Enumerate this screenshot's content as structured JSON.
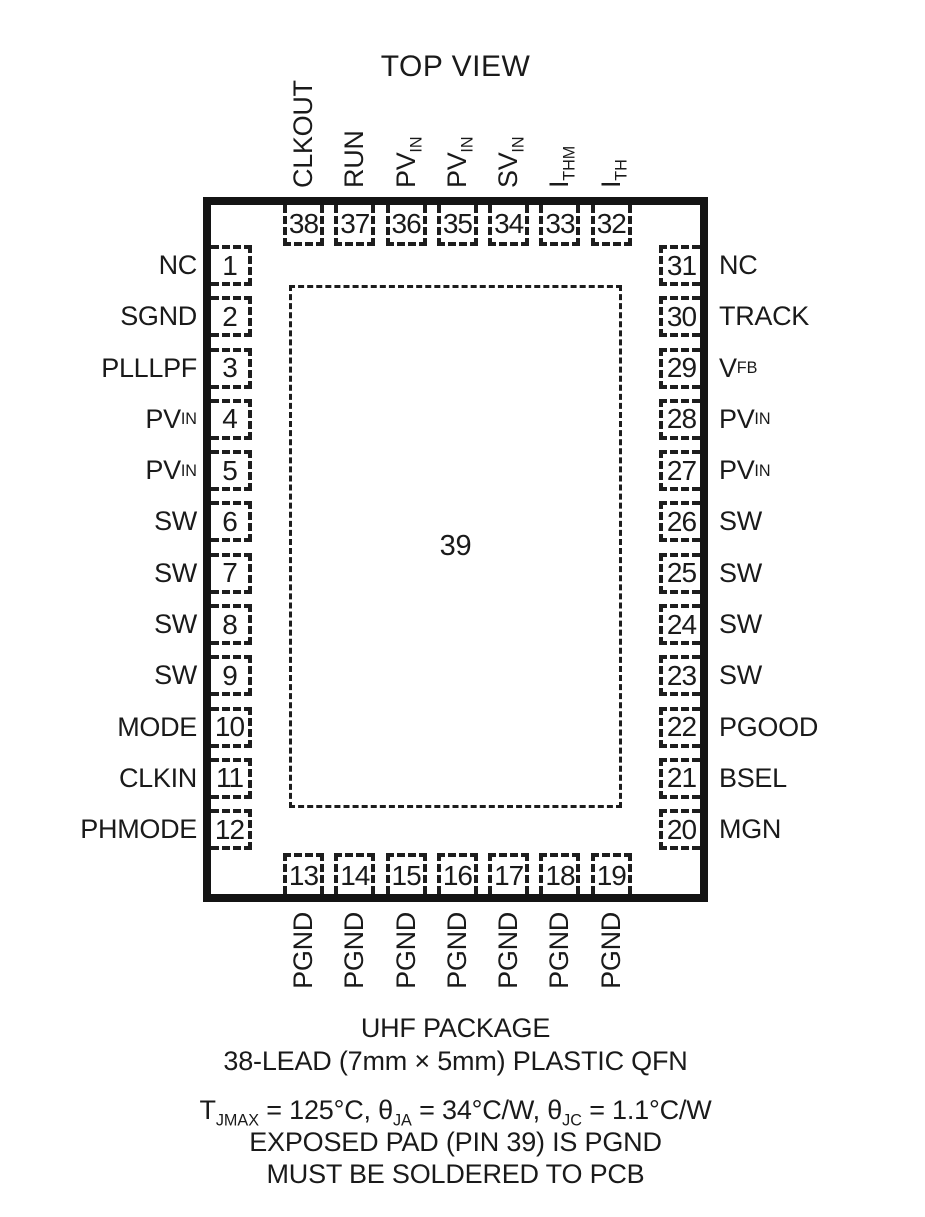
{
  "title": "TOP VIEW",
  "colors": {
    "ink": "#1a1a1a",
    "background": "#ffffff"
  },
  "exposed_pad": {
    "num": "39"
  },
  "pins": {
    "top": [
      {
        "num": "38",
        "main": "CLKOUT",
        "sub": ""
      },
      {
        "num": "37",
        "main": "RUN",
        "sub": ""
      },
      {
        "num": "36",
        "main": "PV",
        "sub": "IN"
      },
      {
        "num": "35",
        "main": "PV",
        "sub": "IN"
      },
      {
        "num": "34",
        "main": "SV",
        "sub": "IN"
      },
      {
        "num": "33",
        "main": "I",
        "sub": "THM"
      },
      {
        "num": "32",
        "main": "I",
        "sub": "TH"
      }
    ],
    "left": [
      {
        "num": "1",
        "main": "NC",
        "sub": ""
      },
      {
        "num": "2",
        "main": "SGND",
        "sub": ""
      },
      {
        "num": "3",
        "main": "PLLLPF",
        "sub": ""
      },
      {
        "num": "4",
        "main": "PV",
        "sub": "IN"
      },
      {
        "num": "5",
        "main": "PV",
        "sub": "IN"
      },
      {
        "num": "6",
        "main": "SW",
        "sub": ""
      },
      {
        "num": "7",
        "main": "SW",
        "sub": ""
      },
      {
        "num": "8",
        "main": "SW",
        "sub": ""
      },
      {
        "num": "9",
        "main": "SW",
        "sub": ""
      },
      {
        "num": "10",
        "main": "MODE",
        "sub": ""
      },
      {
        "num": "11",
        "main": "CLKIN",
        "sub": ""
      },
      {
        "num": "12",
        "main": "PHMODE",
        "sub": ""
      }
    ],
    "right": [
      {
        "num": "31",
        "main": "NC",
        "sub": ""
      },
      {
        "num": "30",
        "main": "TRACK",
        "sub": ""
      },
      {
        "num": "29",
        "main": "V",
        "sub": "FB"
      },
      {
        "num": "28",
        "main": "PV",
        "sub": "IN"
      },
      {
        "num": "27",
        "main": "PV",
        "sub": "IN"
      },
      {
        "num": "26",
        "main": "SW",
        "sub": ""
      },
      {
        "num": "25",
        "main": "SW",
        "sub": ""
      },
      {
        "num": "24",
        "main": "SW",
        "sub": ""
      },
      {
        "num": "23",
        "main": "SW",
        "sub": ""
      },
      {
        "num": "22",
        "main": "PGOOD",
        "sub": ""
      },
      {
        "num": "21",
        "main": "BSEL",
        "sub": ""
      },
      {
        "num": "20",
        "main": "MGN",
        "sub": ""
      }
    ],
    "bottom": [
      {
        "num": "13",
        "main": "PGND",
        "sub": ""
      },
      {
        "num": "14",
        "main": "PGND",
        "sub": ""
      },
      {
        "num": "15",
        "main": "PGND",
        "sub": ""
      },
      {
        "num": "16",
        "main": "PGND",
        "sub": ""
      },
      {
        "num": "17",
        "main": "PGND",
        "sub": ""
      },
      {
        "num": "18",
        "main": "PGND",
        "sub": ""
      },
      {
        "num": "19",
        "main": "PGND",
        "sub": ""
      }
    ]
  },
  "footer": {
    "package_line1": "UHF PACKAGE",
    "package_line2": "38-LEAD (7mm × 5mm) PLASTIC QFN",
    "thermal": {
      "t": "T",
      "t_sub": "JMAX",
      "eq1": " = 125°C, ",
      "theta": "θ",
      "ja_sub": "JA",
      "eq2": " = 34°C/W, ",
      "jc_sub": "JC",
      "eq3": " = 1.1°C/W"
    },
    "note_line1": "EXPOSED PAD (PIN 39) IS PGND",
    "note_line2": "MUST BE SOLDERED TO PCB"
  }
}
